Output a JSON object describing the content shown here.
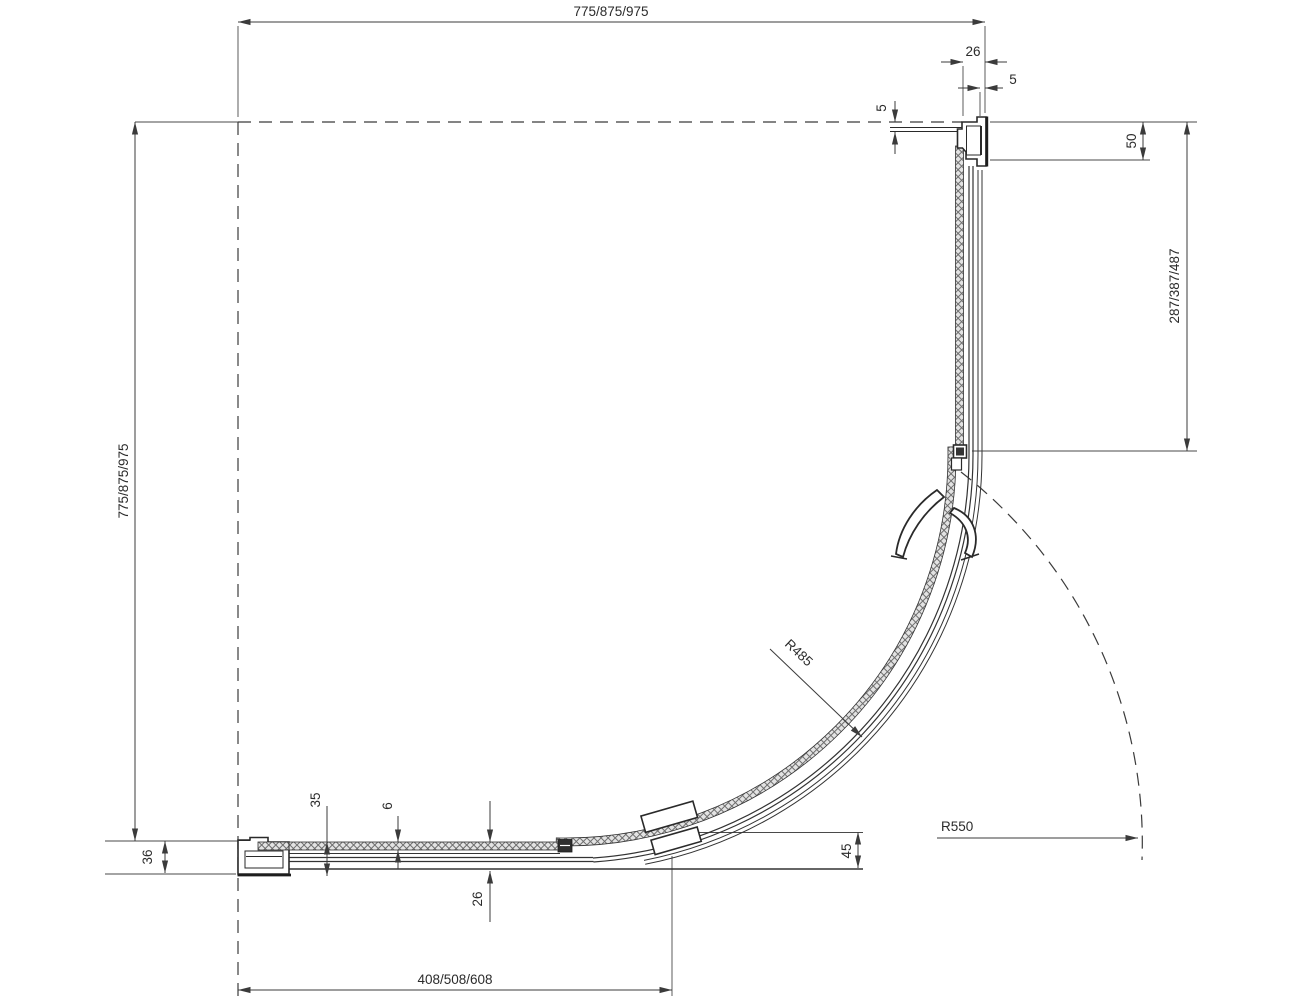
{
  "drawing": {
    "title": "quadrant shower enclosure — dimensioned plan section",
    "dims": {
      "top_width": "775/875/975",
      "left_depth": "775/875/975",
      "side_panel": "287/387/487",
      "front_panel": "408/508/608",
      "profile_width": "26",
      "top_gap": "5",
      "wall_gap": "5",
      "profile_length": "50",
      "bottom_profile": "36",
      "profile_depth": "35",
      "glass_thickness": "6",
      "frame_thickness": "26",
      "door_edge": "45",
      "glass_radius": "R485",
      "swing_radius": "R550"
    }
  }
}
